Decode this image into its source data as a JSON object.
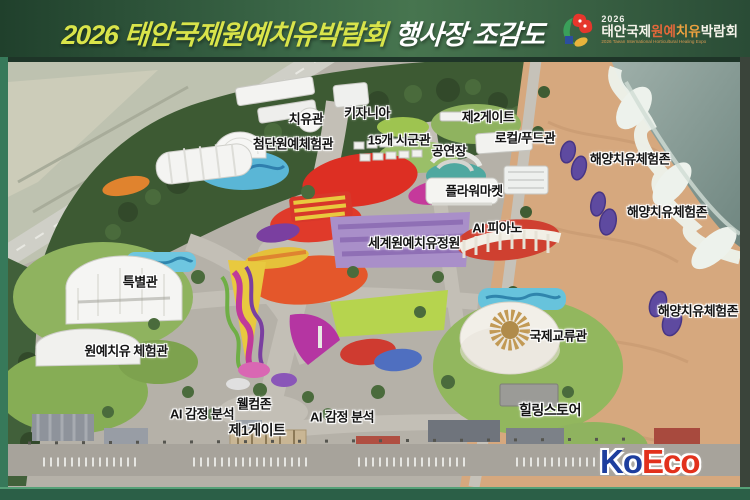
{
  "header": {
    "title_highlight": "2026 태안국제원예치유박람회",
    "title_rest": "행사장 조감도",
    "logo": {
      "year": "2026",
      "name_white1": "태안국제",
      "name_orange1": "원예",
      "name_orange2": "치유",
      "name_white2": "박람회",
      "subtitle": "2026 Taean International Horticultural Healing Expo"
    },
    "colors": {
      "background_dark": "#20402c",
      "background_light": "#47754f",
      "title_highlight": "#d9e44a",
      "title_rest": "#ffffff"
    }
  },
  "map": {
    "labels": [
      {
        "text": "치유관"
      },
      {
        "text": "키자니아"
      },
      {
        "text": "첨단원예체험관"
      },
      {
        "text": "15개 시군관"
      },
      {
        "text": "제2게이트"
      },
      {
        "text": "로컬/푸드관"
      },
      {
        "text": "공연장"
      },
      {
        "text": "플라워마켓"
      },
      {
        "text": "해양치유체험존"
      },
      {
        "text": "해양치유체험존"
      },
      {
        "text": "AI 피아노"
      },
      {
        "text": "세계원예치유정원"
      },
      {
        "text": "특별관"
      },
      {
        "text": "원예치유 체험관"
      },
      {
        "text": "국제교류관"
      },
      {
        "text": "해양치유체험존"
      },
      {
        "text": "웰컴존"
      },
      {
        "text": "AI 감정 분석"
      },
      {
        "text": "AI 감정 분석"
      },
      {
        "text": "제1게이트"
      },
      {
        "text": "힐링스토어"
      }
    ]
  },
  "watermark": {
    "part1": "Ko",
    "part2": "Eco",
    "color1": "#1d3e9e",
    "color2": "#e2311c"
  }
}
